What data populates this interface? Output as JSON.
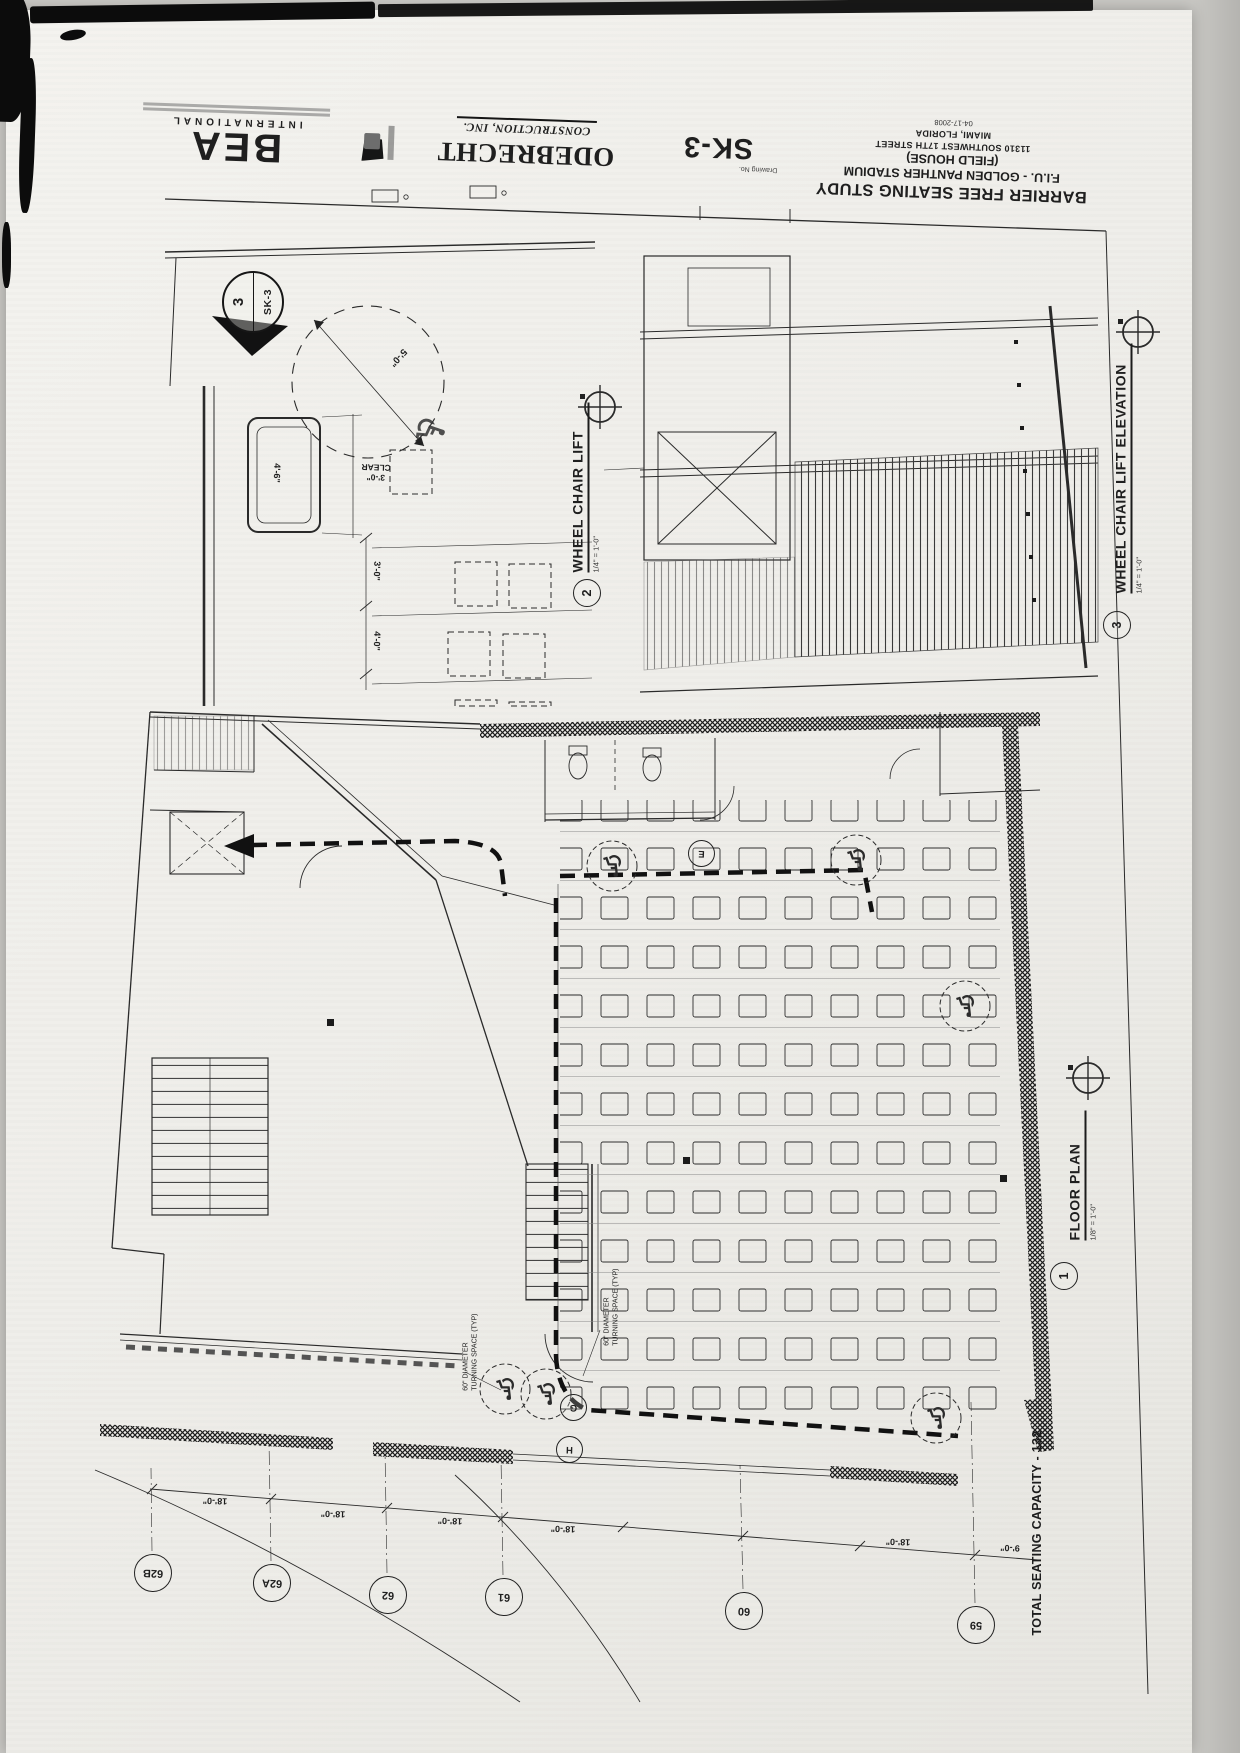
{
  "colors": {
    "ink": "#1f1f1f",
    "paper": "#f2f1ed"
  },
  "title_block": {
    "project_title": "BARRIER FREE SEATING STUDY",
    "project_name": "F.I.U. - GOLDEN PANTHER STADIUM",
    "project_name_2": "(FIELD HOUSE)",
    "address": "11310 SOUTHWEST 17TH STREET",
    "city": "MIAMI, FLORIDA",
    "date": "04-17-2008",
    "drawing_no_label": "Drawing No.",
    "sheet_number": "SK-3",
    "contractor_name": "ODEBRECHT",
    "contractor_subtitle": "CONSTRUCTION, INC.",
    "architect_name": "BEA",
    "architect_subtitle": "INTERNATIONAL"
  },
  "detail_marker": {
    "number": "3",
    "sheet": "SK-3"
  },
  "details": {
    "floor_plan": {
      "bubble": "1",
      "title": "FLOOR PLAN",
      "scale": "1/8\" = 1'-0\""
    },
    "lift_plan": {
      "bubble": "2",
      "title": "WHEEL CHAIR LIFT",
      "scale": "1/4\" = 1'-0\""
    },
    "lift_elevation": {
      "bubble": "3",
      "title": "WHEEL CHAIR LIFT ELEVATION",
      "scale": "1/4\" = 1'-0\""
    }
  },
  "lift_plan_dims": {
    "turning_circle": "5'-0\"",
    "platform": "4'-6\"",
    "clear_line1": "3'-0\"",
    "clear_line2": "CLEAR",
    "row_depth": "3'-0\"",
    "row_depth_2": "4'-0\""
  },
  "floor_plan_notes": {
    "capacity": "TOTAL SEATING CAPACITY - 132",
    "turning_line1": "60\" DIAMETER",
    "turning_line2": "TURNING SPACE (TYP)",
    "bay_dims": [
      "18'-0\"",
      "18'-0\"",
      "18'-0\"",
      "18'-0\"",
      "18'-0\"",
      "9'-0\""
    ],
    "grid_bubbles": [
      "62B",
      "62A",
      "62",
      "61",
      "60",
      "59"
    ],
    "row_bubbles": [
      "E",
      "G",
      "H"
    ]
  },
  "icons": {
    "wheelchair": "♿"
  }
}
